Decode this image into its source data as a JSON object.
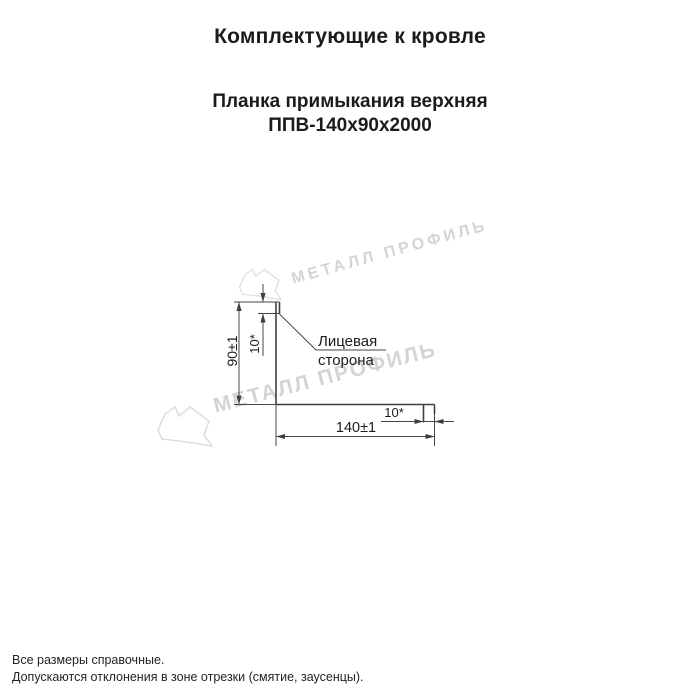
{
  "header": {
    "title": "Комплектующие к кровле",
    "product_name": "Планка примыкания верхняя",
    "product_model": "ППВ-140х90х2000"
  },
  "watermark": {
    "text": "МЕТАЛЛ ПРОФИЛЬ",
    "color": "#d4d4d4"
  },
  "drawing": {
    "labels": {
      "height_dim": "90±1",
      "top_hem_dim": "10*",
      "face_side_line1": "Лицевая",
      "face_side_line2": "сторона",
      "end_fold_dim": "10*",
      "width_dim": "140±1"
    },
    "colors": {
      "line": "#3f3f3f",
      "label_text": "#1c1c1c"
    }
  },
  "footer": {
    "note1": "Все размеры справочные.",
    "note2": "Допускаются отклонения в зоне отрезки (смятие, заусенцы)."
  }
}
